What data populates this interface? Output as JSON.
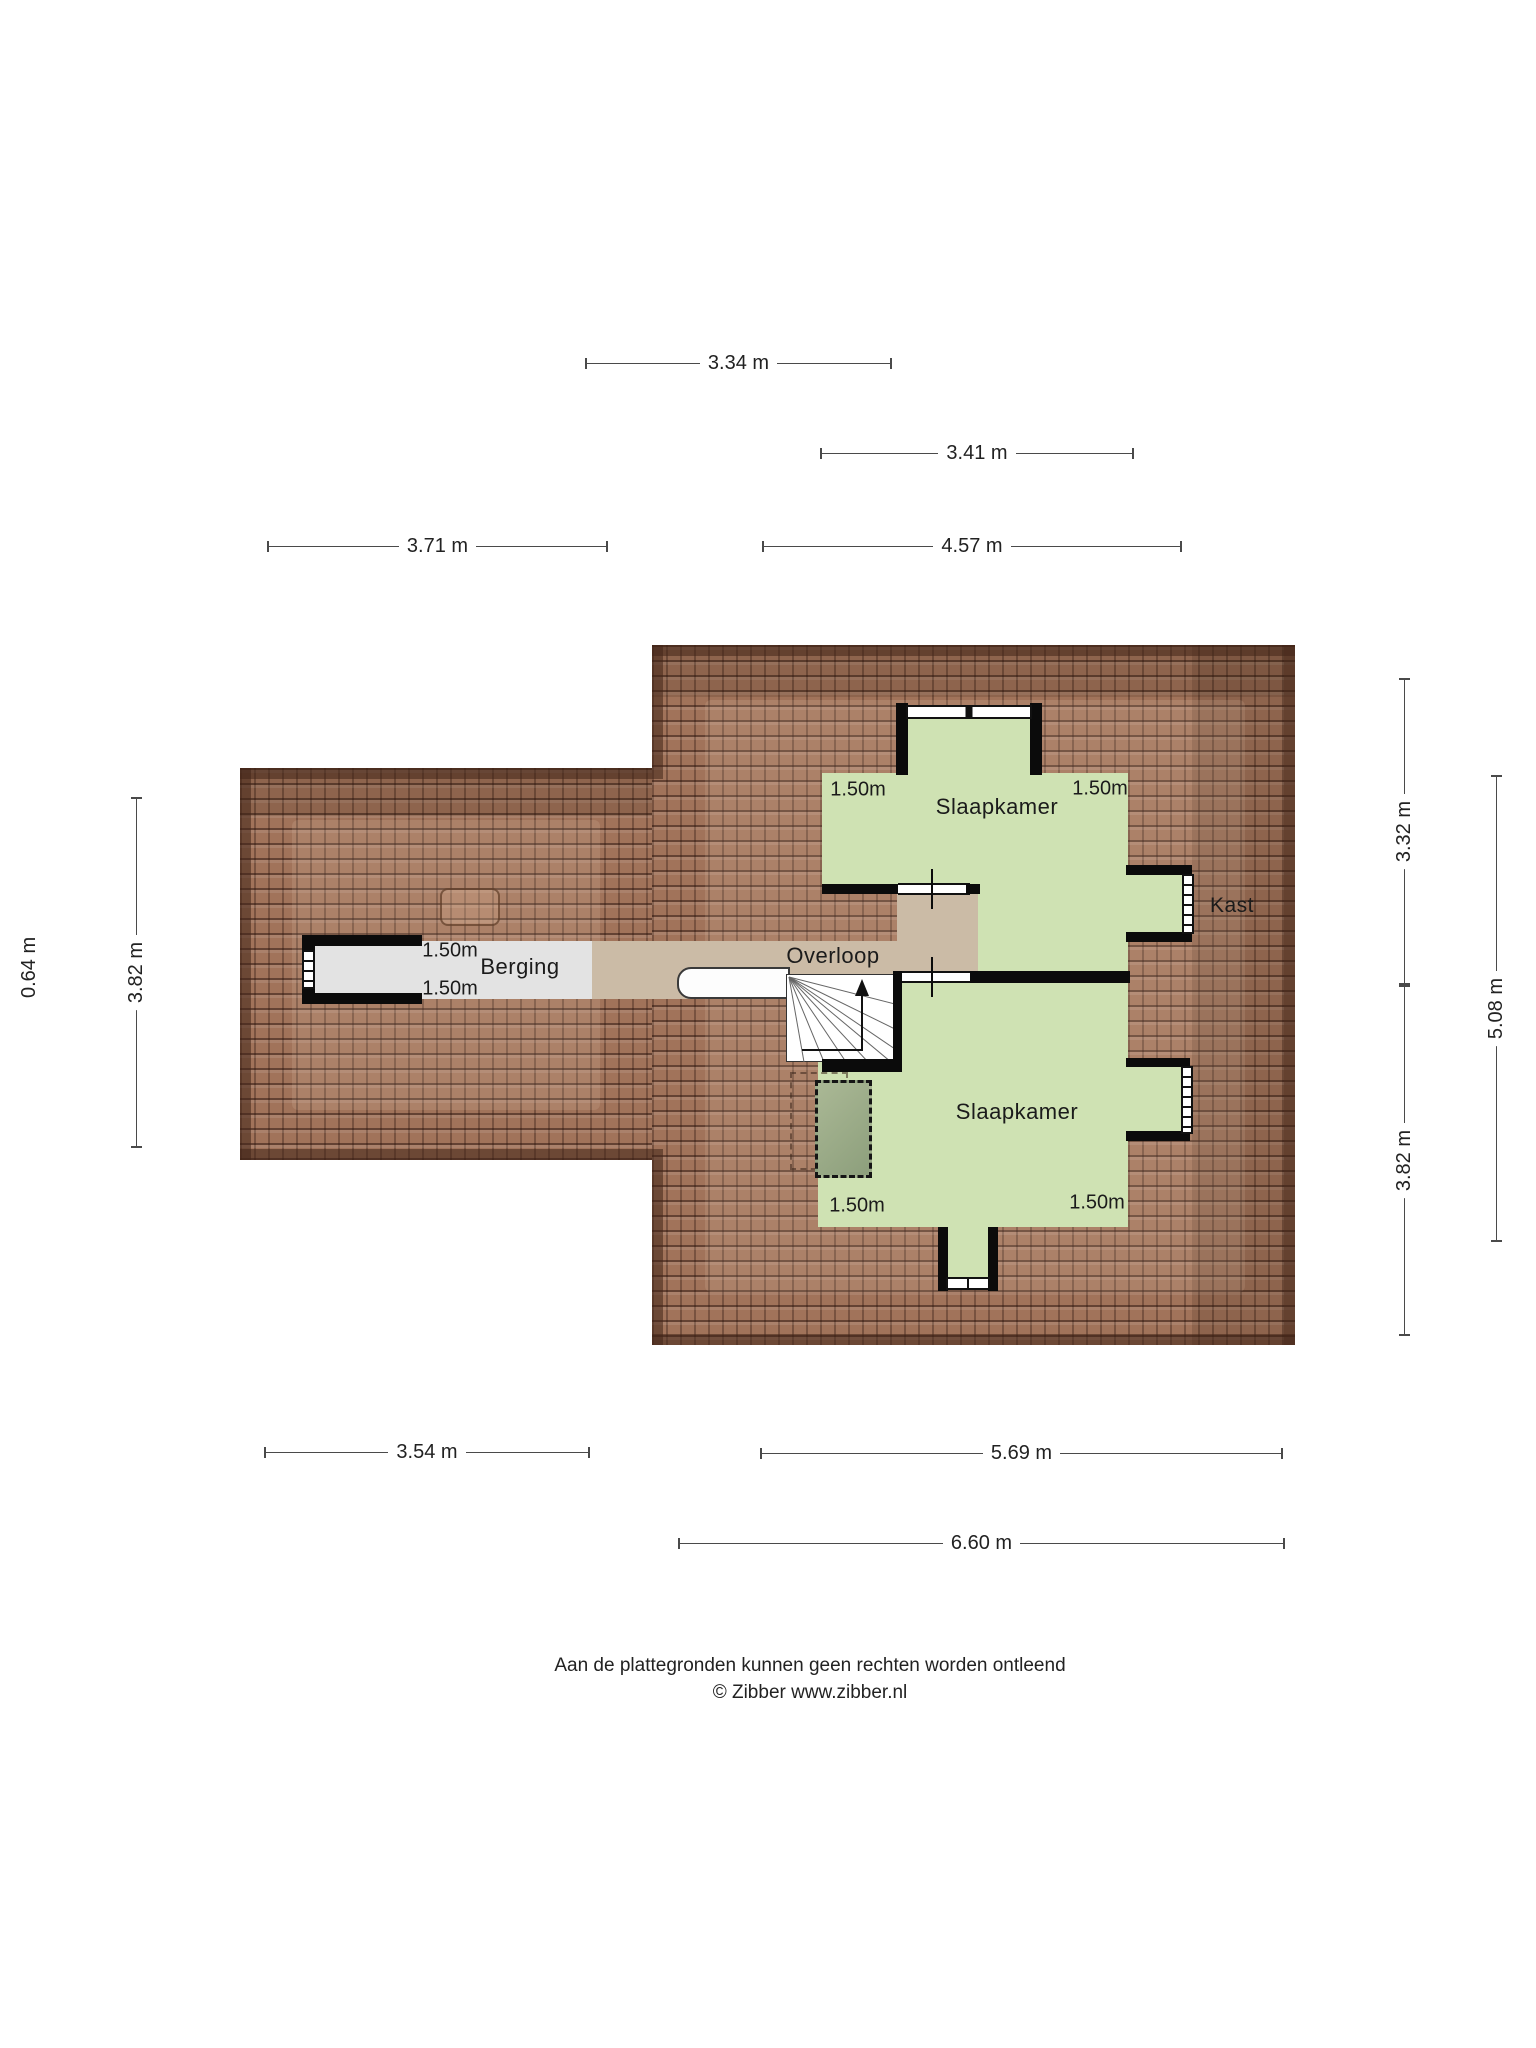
{
  "plan": {
    "rooms": {
      "bedroom_top": "Slaapkamer",
      "closet": "Kast",
      "storage": "Berging",
      "landing": "Overloop",
      "bedroom_bottom": "Slaapkamer"
    },
    "clearances": {
      "storage_top": "1.50m",
      "storage_bottom": "1.50m",
      "bedroom_top_left": "1.50m",
      "bedroom_top_right": "1.50m",
      "bedroom_bottom_left": "1.50m",
      "bedroom_bottom_right": "1.50m"
    },
    "dimensions": {
      "top_row1": "3.34 m",
      "top_row2": "3.41 m",
      "top_left": "3.71 m",
      "top_right": "4.57 m",
      "left_outer": "0.64 m",
      "left_inner": "3.82 m",
      "right_top": "3.32 m",
      "right_bottom": "3.82 m",
      "right_outer": "5.08 m",
      "bottom_left": "3.54 m",
      "bottom_right": "5.69 m",
      "bottom_outer": "6.60 m"
    },
    "colors": {
      "roof": "#a1735a",
      "roof_edge": "#42251 7",
      "room_green": "#cfe2b3",
      "landing_beige": "#cbbba6",
      "storage_grey": "#e3e3e3",
      "wall": "#0b0b0b",
      "dim_line": "#4a4a4a"
    }
  },
  "footer": {
    "disclaimer": "Aan de plattegronden kunnen geen rechten worden ontleend",
    "copyright": "© Zibber www.zibber.nl"
  }
}
